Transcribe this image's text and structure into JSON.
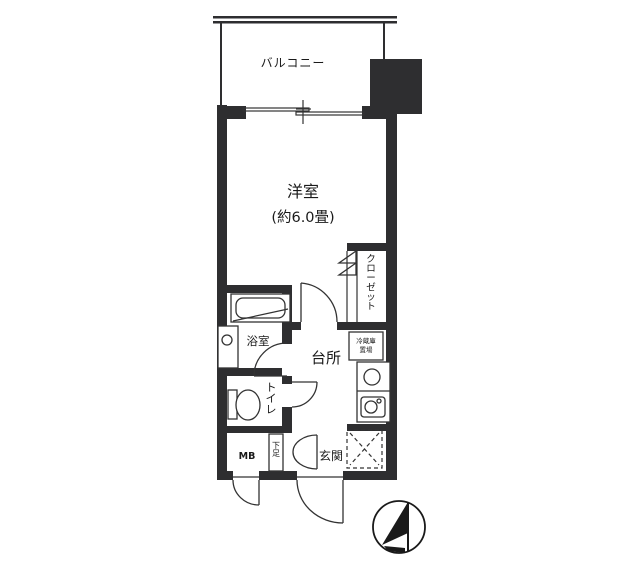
{
  "plan": {
    "balcony_label": "バルコニー",
    "main_room": {
      "label": "洋室",
      "size_label": "(約6.0畳)"
    },
    "closet_label": "クローゼット",
    "bathroom_label": "浴室",
    "kitchen_label": "台所",
    "fridge_label_line1": "冷蔵庫",
    "fridge_label_line2": "置場",
    "toilet_label": "トイレ",
    "meter_box_label": "MB",
    "shoe_box_label": "下足",
    "entrance_label": "玄関"
  },
  "colors": {
    "wall": "#2e2e30",
    "line": "#333333",
    "background": "#ffffff"
  }
}
